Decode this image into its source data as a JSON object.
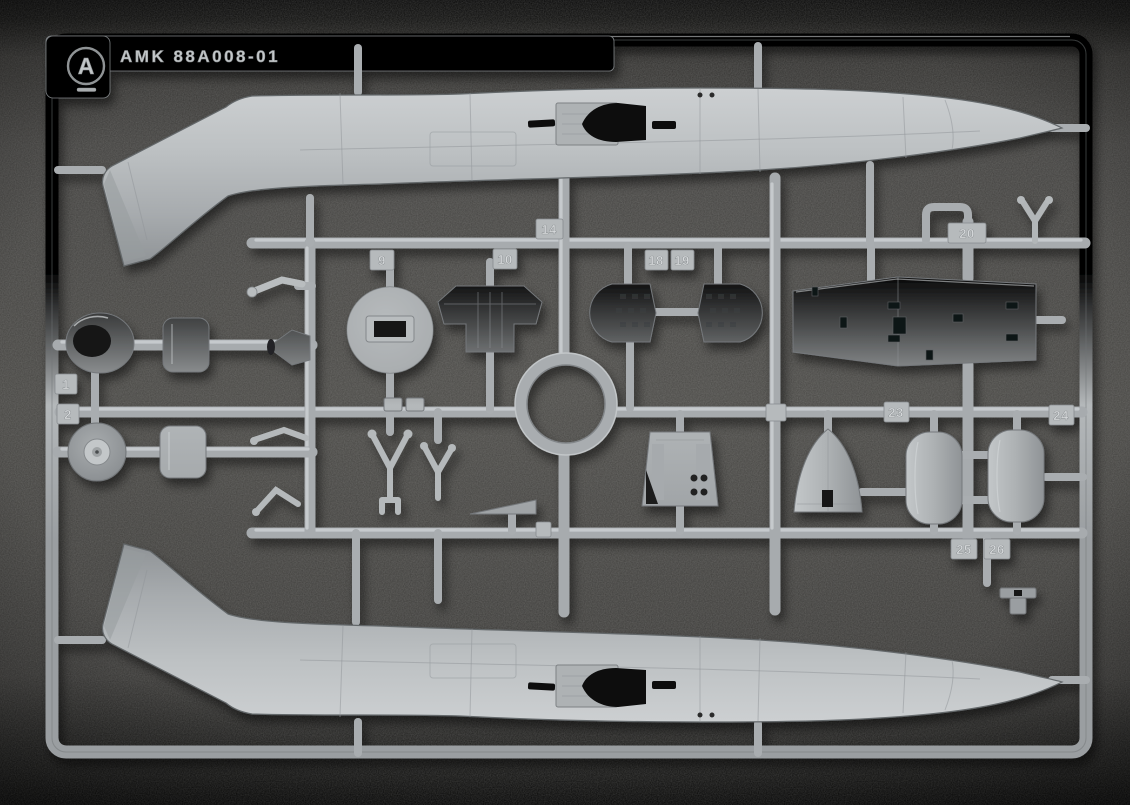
{
  "photo": {
    "subject": "injection-molded-model-kit-sprue",
    "sprue_letter": "A",
    "mold_code": "AMK 88A008-01"
  },
  "colors": {
    "backdrop": "#4b4a47",
    "backdrop_edge": "#0b0b0a",
    "plastic_light": "#d2d5d7",
    "plastic_base": "#b6babc",
    "plastic_shadow": "#85898c",
    "cavity_dark": "#101112"
  },
  "part_tags": {
    "n1": "1",
    "n2": "2",
    "n9": "9",
    "n10": "10",
    "n14": "14",
    "n18": "18",
    "n19": "19",
    "n20": "20",
    "n23": "23",
    "n24": "24",
    "n25": "25",
    "n26": "26"
  }
}
